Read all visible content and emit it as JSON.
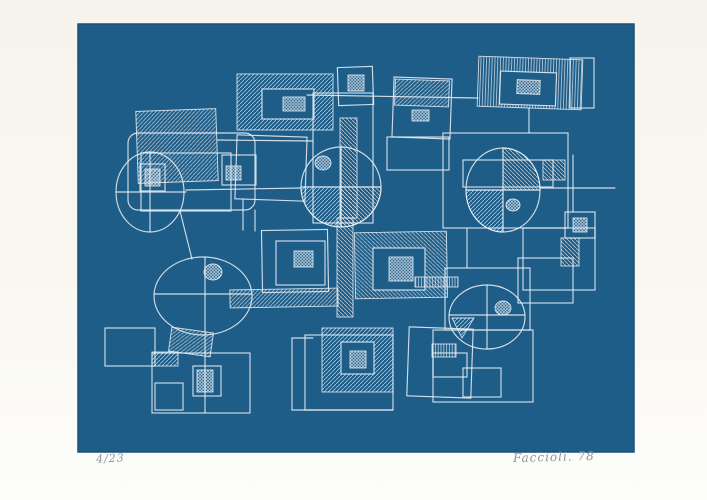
{
  "artwork": {
    "edition_number": "4/23",
    "signature": "Faccioli. 78",
    "colors": {
      "paper": "#f8f6ef",
      "print_blue": "#1e5d88",
      "print_blue_edge": "#17517a",
      "line_white": "#e9eff4",
      "pencil_gray": "#8a94a2"
    },
    "print_area": {
      "x": 78,
      "y": 24,
      "w": 556,
      "h": 428
    },
    "shapes": [
      {
        "t": "rect",
        "x": 137,
        "y": 110,
        "w": 80,
        "h": 72,
        "f": "h1",
        "r": -2
      },
      {
        "t": "rect",
        "x": 128,
        "y": 133,
        "w": 127,
        "h": 77,
        "rx": 10
      },
      {
        "t": "rect",
        "x": 141,
        "y": 153,
        "w": 90,
        "h": 58
      },
      {
        "t": "line",
        "x1": 217,
        "y1": 140,
        "x2": 313,
        "y2": 141
      },
      {
        "t": "ellipse",
        "cx": 150,
        "cy": 192,
        "rx": 34,
        "ry": 40
      },
      {
        "t": "line",
        "x1": 116,
        "y1": 192,
        "x2": 186,
        "y2": 192
      },
      {
        "t": "line",
        "x1": 150,
        "y1": 153,
        "x2": 150,
        "y2": 232
      },
      {
        "t": "rect",
        "x": 140,
        "y": 164,
        "w": 25,
        "h": 27
      },
      {
        "t": "rect",
        "x": 145,
        "y": 169,
        "w": 15,
        "h": 17,
        "f": "x"
      },
      {
        "t": "line",
        "x1": 186,
        "y1": 190,
        "x2": 301,
        "y2": 188
      },
      {
        "t": "line",
        "x1": 180,
        "y1": 211,
        "x2": 192,
        "y2": 259
      },
      {
        "t": "rect",
        "x": 237,
        "y": 74,
        "w": 96,
        "h": 56,
        "f": "h1"
      },
      {
        "t": "rect",
        "x": 262,
        "y": 89,
        "w": 52,
        "h": 30,
        "f": "bg"
      },
      {
        "t": "rect",
        "x": 283,
        "y": 97,
        "w": 22,
        "h": 14,
        "f": "x"
      },
      {
        "t": "rect",
        "x": 236,
        "y": 136,
        "w": 70,
        "h": 64,
        "r": 2
      },
      {
        "t": "rect",
        "x": 222,
        "y": 155,
        "w": 34,
        "h": 30
      },
      {
        "t": "rect",
        "x": 226,
        "y": 166,
        "w": 15,
        "h": 14,
        "f": "x"
      },
      {
        "t": "line",
        "x1": 243,
        "y1": 200,
        "x2": 243,
        "y2": 230
      },
      {
        "t": "line",
        "x1": 255,
        "y1": 210,
        "x2": 255,
        "y2": 231
      },
      {
        "t": "rect",
        "x": 338,
        "y": 67,
        "w": 35,
        "h": 38,
        "r": -2
      },
      {
        "t": "rect",
        "x": 348,
        "y": 75,
        "w": 16,
        "h": 16,
        "f": "x"
      },
      {
        "t": "line",
        "x1": 307,
        "y1": 95,
        "x2": 478,
        "y2": 98
      },
      {
        "t": "rect",
        "x": 313,
        "y": 93,
        "w": 60,
        "h": 130
      },
      {
        "t": "rect",
        "x": 387,
        "y": 137,
        "w": 62,
        "h": 33
      },
      {
        "t": "rect",
        "x": 393,
        "y": 78,
        "w": 58,
        "h": 60,
        "r": 2
      },
      {
        "t": "rect",
        "x": 395,
        "y": 80,
        "w": 54,
        "h": 26,
        "f": "h1",
        "r": 2
      },
      {
        "t": "rect",
        "x": 412,
        "y": 110,
        "w": 17,
        "h": 11,
        "f": "x"
      },
      {
        "t": "rect",
        "x": 478,
        "y": 58,
        "w": 104,
        "h": 50,
        "f": "v",
        "r": 2
      },
      {
        "t": "rect",
        "x": 500,
        "y": 72,
        "w": 56,
        "h": 33,
        "f": "bg",
        "r": 2
      },
      {
        "t": "rect",
        "x": 517,
        "y": 80,
        "w": 23,
        "h": 14,
        "f": "x",
        "r": 2
      },
      {
        "t": "rect",
        "x": 570,
        "y": 58,
        "w": 24,
        "h": 50
      },
      {
        "t": "line",
        "x1": 529,
        "y1": 108,
        "x2": 529,
        "y2": 133
      },
      {
        "t": "rect",
        "x": 443,
        "y": 133,
        "w": 125,
        "h": 95
      },
      {
        "t": "rect",
        "x": 463,
        "y": 160,
        "w": 90,
        "h": 27
      },
      {
        "t": "rect",
        "x": 543,
        "y": 160,
        "w": 22,
        "h": 20,
        "f": "h2"
      },
      {
        "t": "path",
        "d": "M503,148 A37,42 0 0 1 540,190 L503,190 Z",
        "f": "h2"
      },
      {
        "t": "path",
        "d": "M503,190 L466,190 A37,42 0 0 0 503,232 Z",
        "f": "h1"
      },
      {
        "t": "ellipse",
        "cx": 503,
        "cy": 190,
        "rx": 37,
        "ry": 42
      },
      {
        "t": "line",
        "x1": 466,
        "y1": 190,
        "x2": 540,
        "y2": 190
      },
      {
        "t": "line",
        "x1": 503,
        "y1": 148,
        "x2": 503,
        "y2": 232
      },
      {
        "t": "ellipse",
        "cx": 513,
        "cy": 205,
        "rx": 7,
        "ry": 6,
        "f": "x"
      },
      {
        "t": "line",
        "x1": 540,
        "y1": 188,
        "x2": 615,
        "y2": 188
      },
      {
        "t": "rect",
        "x": 565,
        "y": 212,
        "w": 30,
        "h": 26
      },
      {
        "t": "rect",
        "x": 573,
        "y": 218,
        "w": 14,
        "h": 14,
        "f": "x"
      },
      {
        "t": "rect",
        "x": 561,
        "y": 238,
        "w": 18,
        "h": 28,
        "f": "h2"
      },
      {
        "t": "line",
        "x1": 573,
        "y1": 155,
        "x2": 573,
        "y2": 212
      },
      {
        "t": "rect",
        "x": 340,
        "y": 118,
        "w": 17,
        "h": 100,
        "f": "h2"
      },
      {
        "t": "rect",
        "x": 337,
        "y": 218,
        "w": 16,
        "h": 99,
        "f": "h2"
      },
      {
        "t": "path",
        "d": "M341,187 L301,187 A40,40 0 0 0 341,227 Z",
        "f": "h1"
      },
      {
        "t": "path",
        "d": "M381,187 A40,40 0 0 1 341,227 L341,187 Z",
        "f": "h2"
      },
      {
        "t": "ellipse",
        "cx": 341,
        "cy": 187,
        "rx": 40,
        "ry": 40
      },
      {
        "t": "line",
        "x1": 301,
        "y1": 187,
        "x2": 381,
        "y2": 187
      },
      {
        "t": "line",
        "x1": 341,
        "y1": 147,
        "x2": 341,
        "y2": 227
      },
      {
        "t": "ellipse",
        "cx": 323,
        "cy": 163,
        "rx": 8,
        "ry": 7,
        "f": "x"
      },
      {
        "t": "rect",
        "x": 262,
        "y": 230,
        "w": 66,
        "h": 62,
        "r": -1
      },
      {
        "t": "rect",
        "x": 276,
        "y": 241,
        "w": 49,
        "h": 44
      },
      {
        "t": "rect",
        "x": 294,
        "y": 251,
        "w": 19,
        "h": 16,
        "f": "x"
      },
      {
        "t": "rect",
        "x": 230,
        "y": 289,
        "w": 108,
        "h": 18,
        "f": "h1",
        "r": -1
      },
      {
        "t": "path",
        "d": "M313,338 L292,338 L292,410 L393,410",
        "f": "none"
      },
      {
        "t": "rect",
        "x": 305,
        "y": 335,
        "w": 88,
        "h": 75
      },
      {
        "t": "rect",
        "x": 322,
        "y": 328,
        "w": 71,
        "h": 64,
        "f": "h1"
      },
      {
        "t": "rect",
        "x": 341,
        "y": 342,
        "w": 33,
        "h": 32,
        "f": "bg"
      },
      {
        "t": "rect",
        "x": 350,
        "y": 351,
        "w": 16,
        "h": 17,
        "f": "x"
      },
      {
        "t": "rect",
        "x": 355,
        "y": 232,
        "w": 92,
        "h": 66,
        "f": "h2",
        "r": -1
      },
      {
        "t": "rect",
        "x": 373,
        "y": 248,
        "w": 52,
        "h": 42,
        "f": "bg"
      },
      {
        "t": "rect",
        "x": 389,
        "y": 257,
        "w": 24,
        "h": 24,
        "f": "x"
      },
      {
        "t": "rect",
        "x": 415,
        "y": 277,
        "w": 43,
        "h": 10,
        "f": "v"
      },
      {
        "t": "line",
        "x1": 467,
        "y1": 228,
        "x2": 467,
        "y2": 268
      },
      {
        "t": "rect",
        "x": 445,
        "y": 268,
        "w": 85,
        "h": 62
      },
      {
        "t": "rect",
        "x": 518,
        "y": 258,
        "w": 55,
        "h": 45
      },
      {
        "t": "rect",
        "x": 523,
        "y": 228,
        "w": 72,
        "h": 62
      },
      {
        "t": "path",
        "d": "M452,318 L474,318 L462,338 Z",
        "f": "h1"
      },
      {
        "t": "ellipse",
        "cx": 487,
        "cy": 317,
        "rx": 38,
        "ry": 32
      },
      {
        "t": "line",
        "x1": 449,
        "y1": 315,
        "x2": 525,
        "y2": 315
      },
      {
        "t": "line",
        "x1": 487,
        "y1": 285,
        "x2": 487,
        "y2": 349
      },
      {
        "t": "ellipse",
        "cx": 503,
        "cy": 308,
        "rx": 8,
        "ry": 7,
        "f": "x"
      },
      {
        "t": "rect",
        "x": 433,
        "y": 330,
        "w": 100,
        "h": 72
      },
      {
        "t": "rect",
        "x": 408,
        "y": 328,
        "w": 64,
        "h": 69,
        "r": 2
      },
      {
        "t": "rect",
        "x": 432,
        "y": 344,
        "w": 24,
        "h": 13,
        "f": "v"
      },
      {
        "t": "rect",
        "x": 433,
        "y": 353,
        "w": 34,
        "h": 24
      },
      {
        "t": "rect",
        "x": 463,
        "y": 368,
        "w": 38,
        "h": 29
      },
      {
        "t": "ellipse",
        "cx": 203,
        "cy": 296,
        "rx": 49,
        "ry": 39
      },
      {
        "t": "line",
        "x1": 154,
        "y1": 294,
        "x2": 252,
        "y2": 294
      },
      {
        "t": "line",
        "x1": 205,
        "y1": 257,
        "x2": 205,
        "y2": 335
      },
      {
        "t": "ellipse",
        "cx": 213,
        "cy": 272,
        "rx": 9,
        "ry": 8,
        "f": "x"
      },
      {
        "t": "rect",
        "x": 170,
        "y": 330,
        "w": 42,
        "h": 24,
        "f": "h1",
        "r": 8
      },
      {
        "t": "rect",
        "x": 105,
        "y": 328,
        "w": 50,
        "h": 38
      },
      {
        "t": "rect",
        "x": 152,
        "y": 353,
        "w": 98,
        "h": 60
      },
      {
        "t": "rect",
        "x": 152,
        "y": 352,
        "w": 26,
        "h": 14,
        "f": "h1"
      },
      {
        "t": "rect",
        "x": 155,
        "y": 383,
        "w": 28,
        "h": 27
      },
      {
        "t": "rect",
        "x": 193,
        "y": 366,
        "w": 28,
        "h": 30
      },
      {
        "t": "rect",
        "x": 197,
        "y": 370,
        "w": 16,
        "h": 22,
        "f": "x"
      },
      {
        "t": "line",
        "x1": 205,
        "y1": 335,
        "x2": 205,
        "y2": 413
      }
    ]
  }
}
